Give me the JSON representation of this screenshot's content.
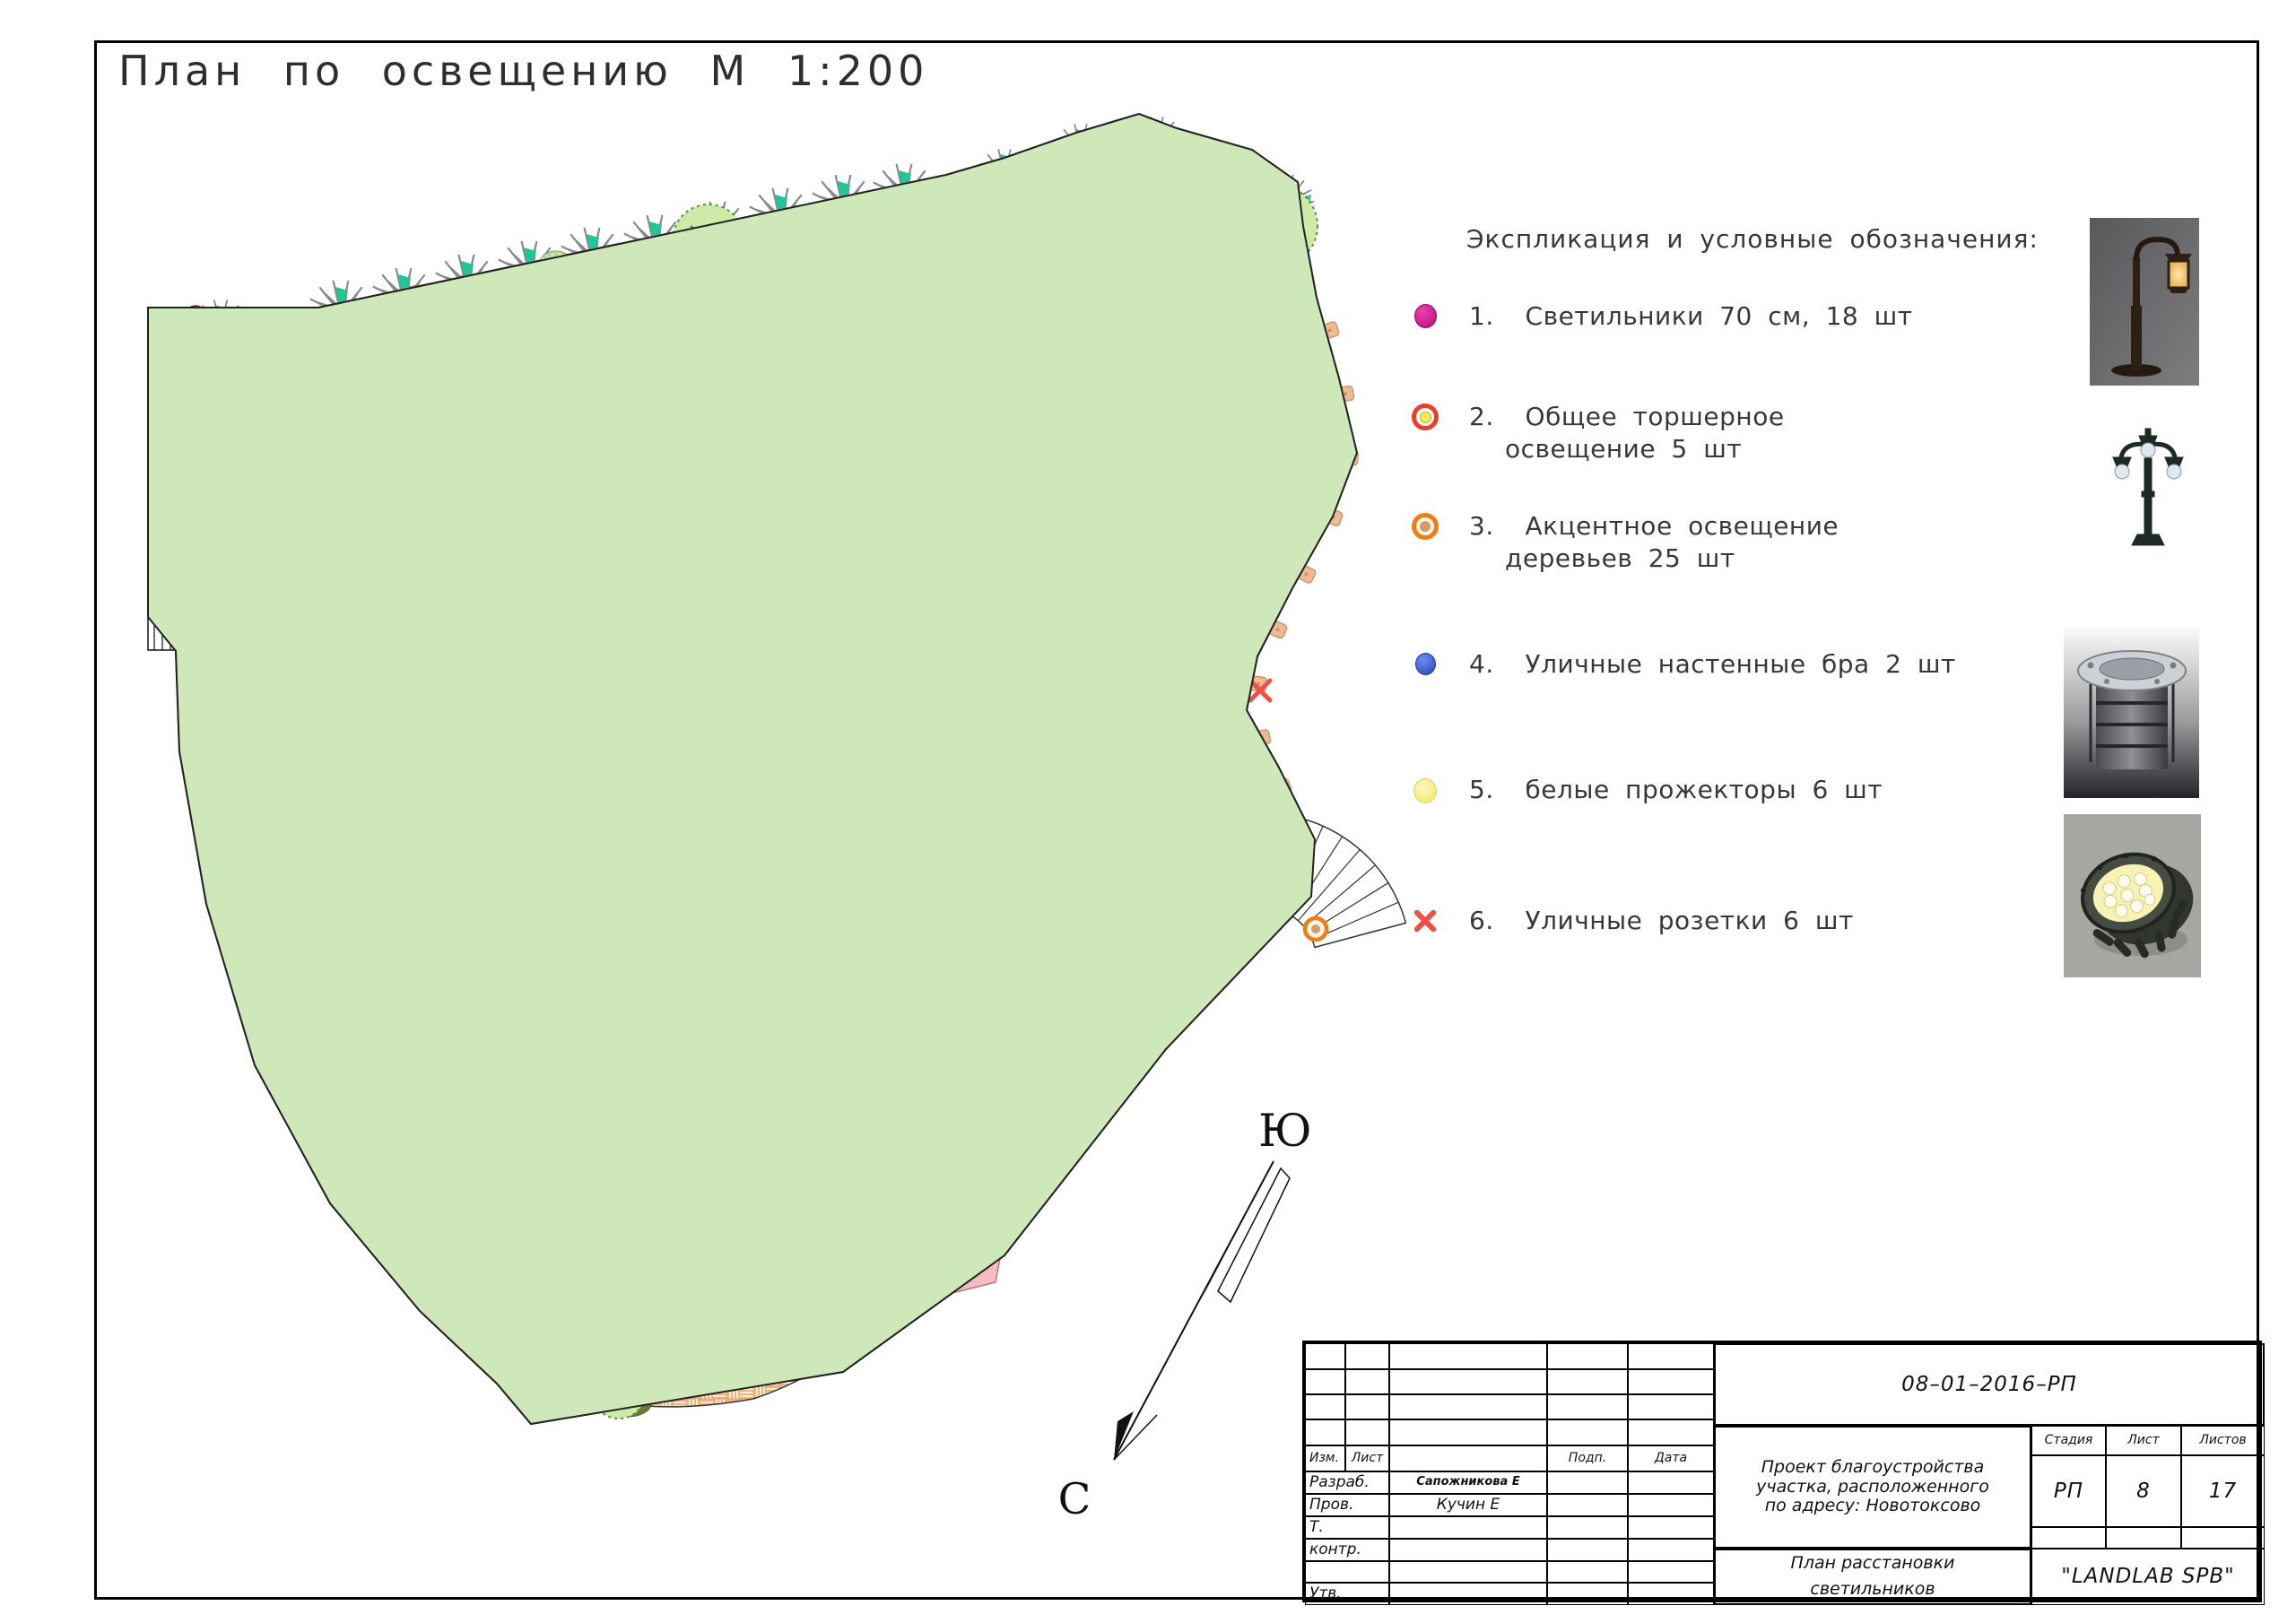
{
  "page": {
    "title": "План по освещению М 1:200"
  },
  "legend": {
    "header": "Экспликация и условные обозначения:",
    "items": [
      {
        "num": "1.",
        "symbol": "magenta-lamp-icon",
        "text": "Светильники 70 см, 18 шт",
        "line2": ""
      },
      {
        "num": "2.",
        "symbol": "red-ring-yellow-icon",
        "text": "Общее торшерное",
        "line2": "освещение 5 шт"
      },
      {
        "num": "3.",
        "symbol": "orange-ring-tan-icon",
        "text": "Акцентное освещение",
        "line2": "деревьев 25 шт"
      },
      {
        "num": "4.",
        "symbol": "blue-dot-icon",
        "text": "Уличные настенные бра 2 шт",
        "line2": ""
      },
      {
        "num": "5.",
        "symbol": "yellow-dot-icon",
        "text": "белые прожекторы 6 шт",
        "line2": ""
      },
      {
        "num": "6.",
        "symbol": "red-x-icon",
        "text": "Уличные розетки 6 шт",
        "line2": ""
      }
    ]
  },
  "compass": {
    "south_label": "Ю",
    "north_label": "С"
  },
  "title_block": {
    "doc_number": "08–01–2016–РП",
    "project_line1": "Проект благоустройства",
    "project_line2": "участка, расположенного",
    "project_line3": "по адресу: Новотоксово",
    "stage_header": "Стадия",
    "sheet_header": "Лист",
    "sheets_header": "Листов",
    "stage": "РП",
    "sheet": "8",
    "sheets": "17",
    "drawing_name_line1": "План расстановки",
    "drawing_name_line2": "светильников",
    "company": "\"LANDLAB SPB\"",
    "rows": {
      "izm": "Изм.",
      "list": "Лист",
      "podp": "Подп.",
      "data": "Дата",
      "razrab_label": "Разраб.",
      "razrab_value": "Сапожникова Е",
      "prov_label": "Пров.",
      "prov_value": "Кучин Е",
      "t_label": "Т.",
      "kontr_label": "контр.",
      "utv_label": "Утв."
    }
  },
  "colors": {
    "lamp_magenta": "#cc0e8f",
    "torcher_ring": "#e8402a",
    "torcher_center": "#f3ef55",
    "accent_ring": "#f07f13",
    "accent_center": "#d59a67",
    "sconce_blue": "#2f55cf",
    "floodlight_yellow": "#f3ee79",
    "outlet_red": "#ef5045",
    "lawn_green": "#cfe8ba",
    "path_brick": "#d7d0c8",
    "playground_orange": "#f0b47c",
    "terrace_salmon": "#d98a6b",
    "terrace_pink": "#f5c3ca",
    "hedge_teal": "#22c596"
  }
}
